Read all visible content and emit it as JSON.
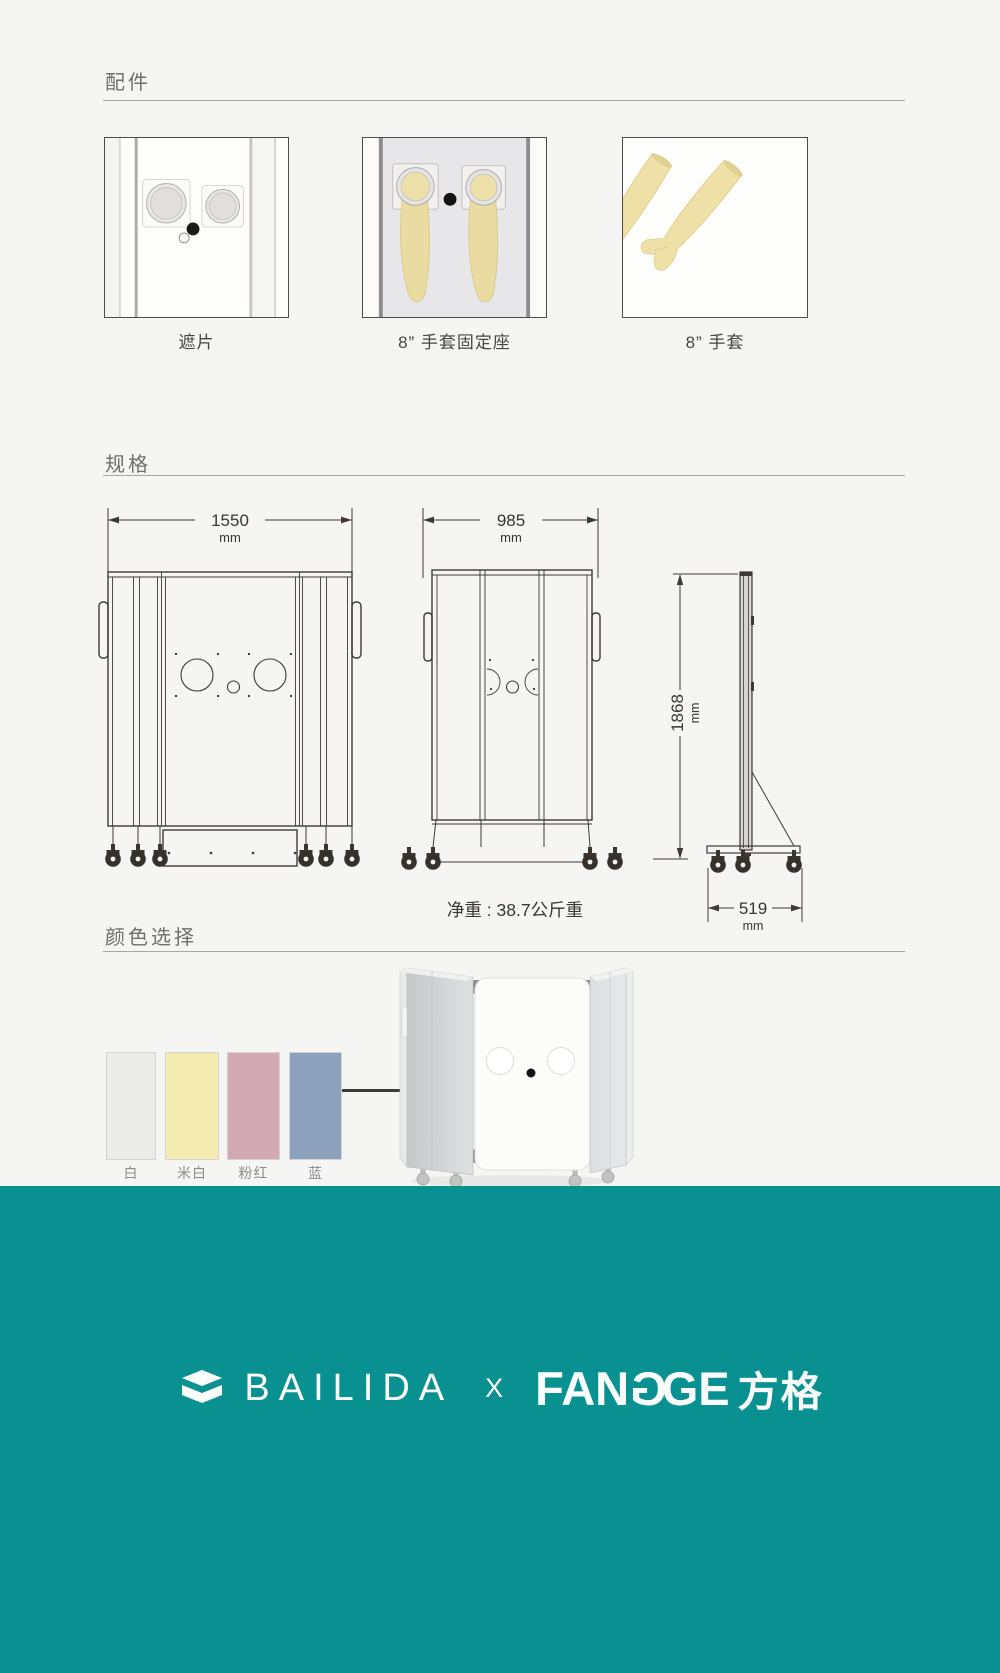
{
  "accessories": {
    "title": "配件",
    "items": [
      {
        "label": "遮片"
      },
      {
        "label": "8” 手套固定座"
      },
      {
        "label": "8” 手套"
      }
    ]
  },
  "specs": {
    "title": "规格",
    "front_width": {
      "value": "1550",
      "unit": "mm"
    },
    "folded_width": {
      "value": "985",
      "unit": "mm"
    },
    "height": {
      "value": "1868",
      "unit": "mm"
    },
    "depth": {
      "value": "519",
      "unit": "mm"
    },
    "net_weight": "净重 : 38.7公斤重"
  },
  "color_selection": {
    "title": "颜色选择",
    "swatches": [
      {
        "label": "白",
        "color": "#ebebe9"
      },
      {
        "label": "米白",
        "color": "#f4ecb0"
      },
      {
        "label": "粉红",
        "color": "#d4a9b6"
      },
      {
        "label": "蓝",
        "color": "#8ca2bc"
      }
    ]
  },
  "footer": {
    "background": "#089190",
    "brand_left": "BAILIDA",
    "separator": "X",
    "brand_right_latin_1": "FAN",
    "brand_right_latin_g1": "G",
    "brand_right_latin_2": "GE",
    "brand_right_cjk": "方格"
  }
}
